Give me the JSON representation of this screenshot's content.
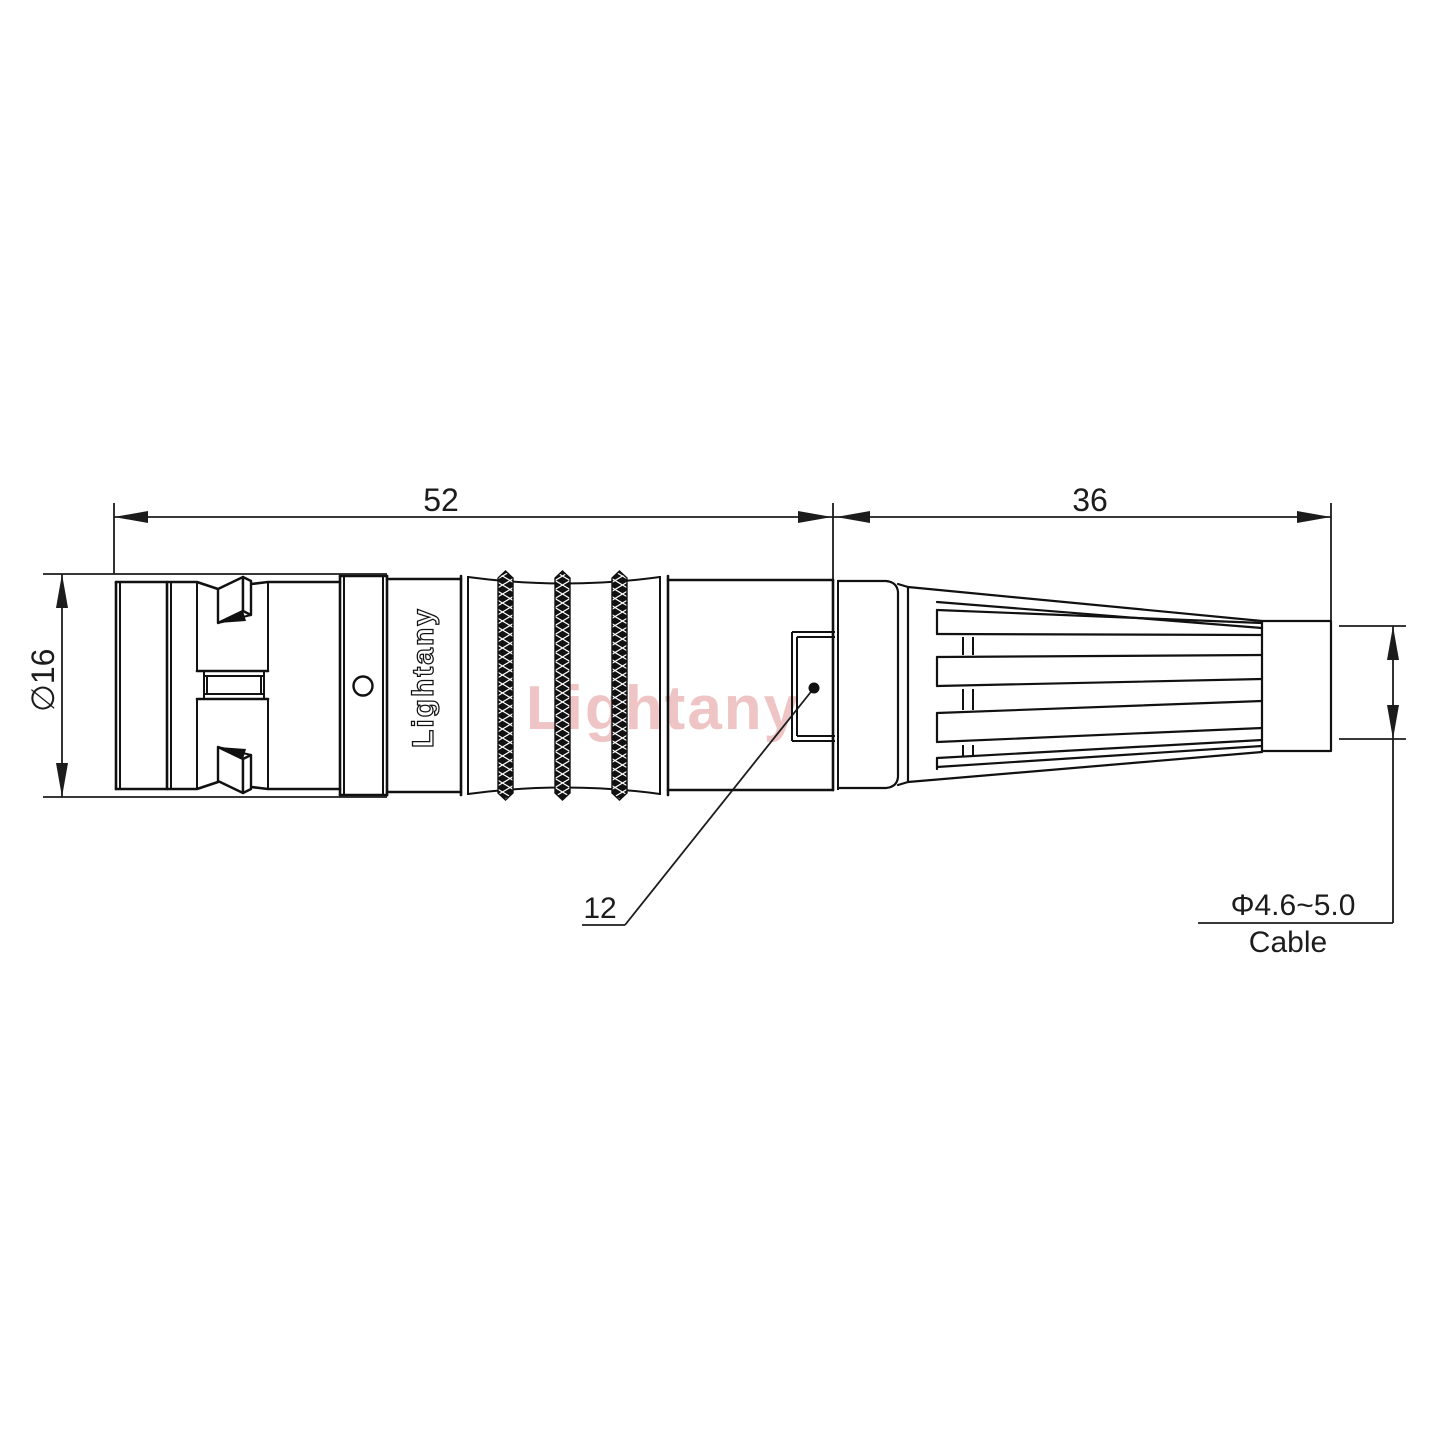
{
  "watermark": {
    "text": "Lightany",
    "color": "#eec4c4"
  },
  "brand": {
    "logo_text": "Lightany"
  },
  "dimensions": {
    "body_length": "52",
    "boot_length": "36",
    "outer_diameter": "∅16",
    "item_ref": "12",
    "cable_diameter": "Φ4.6~5.0",
    "cable_label": "Cable"
  }
}
